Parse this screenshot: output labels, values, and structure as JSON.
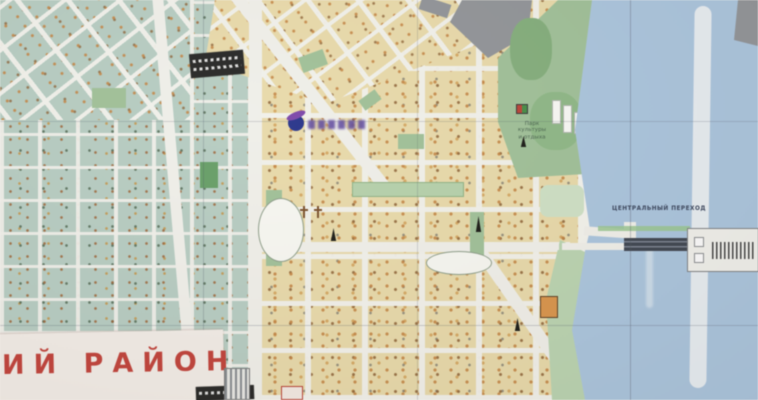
{
  "labels": {
    "district_partial": "ИЙ РАЙОН",
    "central_crossing": "ЦЕНТРАЛЬНЫЙ ПЕРЕХОД",
    "park": "Парк\nкультуры\nи отдыха"
  },
  "colors": {
    "water": "#a9c6e2",
    "teal_blocks": "#b5cec2",
    "tan_blocks": "#ecdca6",
    "park": "#9dc294",
    "street": "#f3f2ec",
    "district_red": "#c93a31",
    "bridge_dark": "#39404c",
    "industrial_gray": "#8f9397",
    "sandbar": "#edf2f5"
  },
  "icons": [
    "monument-icon",
    "church-icon",
    "advert-logo",
    "attraction-icon",
    "stadium-oval",
    "bridge-deck",
    "dam-structure",
    "sandbar-island",
    "pier-icon",
    "landmark-building"
  ]
}
